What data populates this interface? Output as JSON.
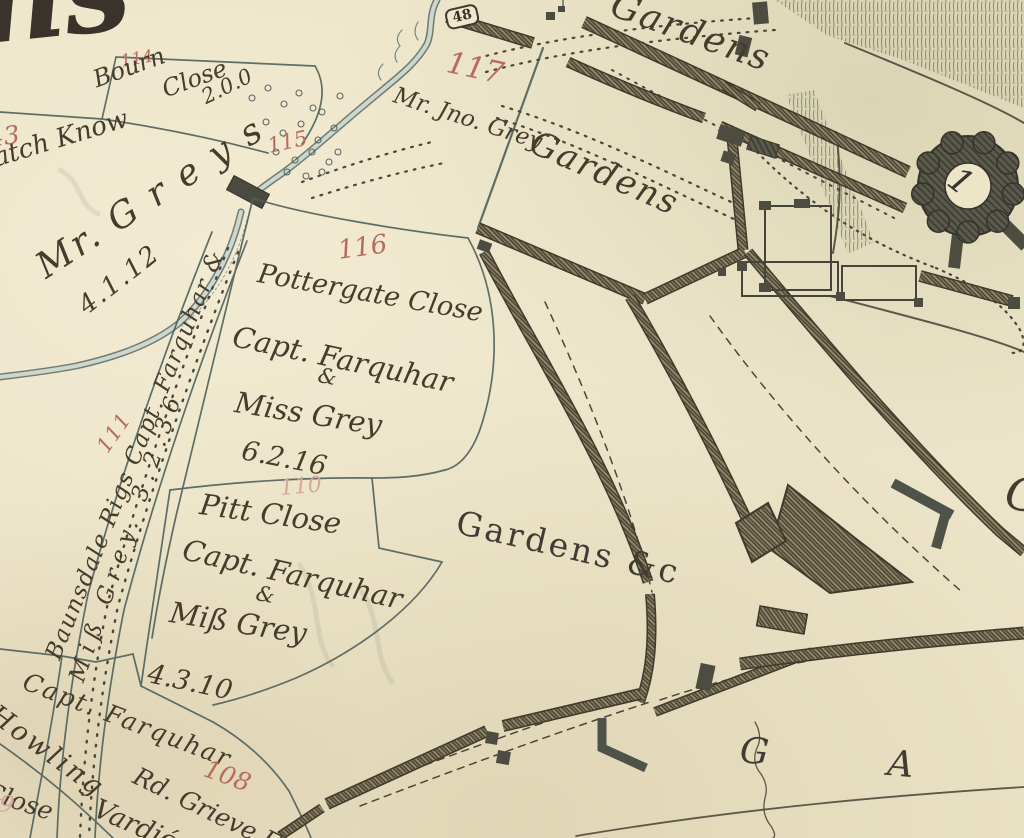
{
  "palette": {
    "paper": "#ece4c8",
    "ink": "#453c2d",
    "red_number": "#b96a5e",
    "red_faint": "#d6a89a",
    "boundary": "#50605c",
    "wall_fill": "#96896c",
    "wall_hatch": "#45412f",
    "dark_structure": "#4c4c41",
    "stream_edge": "#4e6060",
    "stream_fill": "#cdd7cb",
    "grass": "#7c8166"
  },
  "labels": {
    "corner_script": "ns",
    "p114_number": "114",
    "p114_name1": "Bourn",
    "p114_name2": "Close",
    "p114_area": "2.0.0",
    "p43_number": "43",
    "p43_name": "atch Know",
    "greys_name": "Mr. G r e y s",
    "greys_area": "4.1.12",
    "p115_number": "115",
    "marker_48": "48",
    "p117_number": "117",
    "p117_owner": "Mr. Jno. Grey",
    "gardens_top": "Gardens",
    "gardens_walled": "Gardens",
    "p116_number": "116",
    "p116_name": "Pottergate Close",
    "p116_owner1": "Capt. Farquhar",
    "p116_amp": "&",
    "p116_owner2": "Miss Grey",
    "p116_area": "6.2.16",
    "p111_number": "111",
    "p111_line1": "Baunsdale Rigs Capt. Farquhar &",
    "p111_line2": "Miß Grey. 3.2.36",
    "p110_number": "110",
    "p110_name": "Pitt Close",
    "p110_owner1": "Capt. Farquhar",
    "p110_amp": "&",
    "p110_owner2": "Miß Grey",
    "p110_area": "4.3.10",
    "gardens_centre": "Gardens &c",
    "sw_owner": "Capt. Farquhar",
    "sw_howling": "Howling",
    "sw_close": "Close",
    "p108_number": "108",
    "p108_owner": "Rd. Grieve Esq",
    "sw_vardie": "Vardié Cl",
    "gardens_spaced": "G A R D",
    "keep_number": "1",
    "edge_g": "G",
    "edge_red": "09"
  }
}
